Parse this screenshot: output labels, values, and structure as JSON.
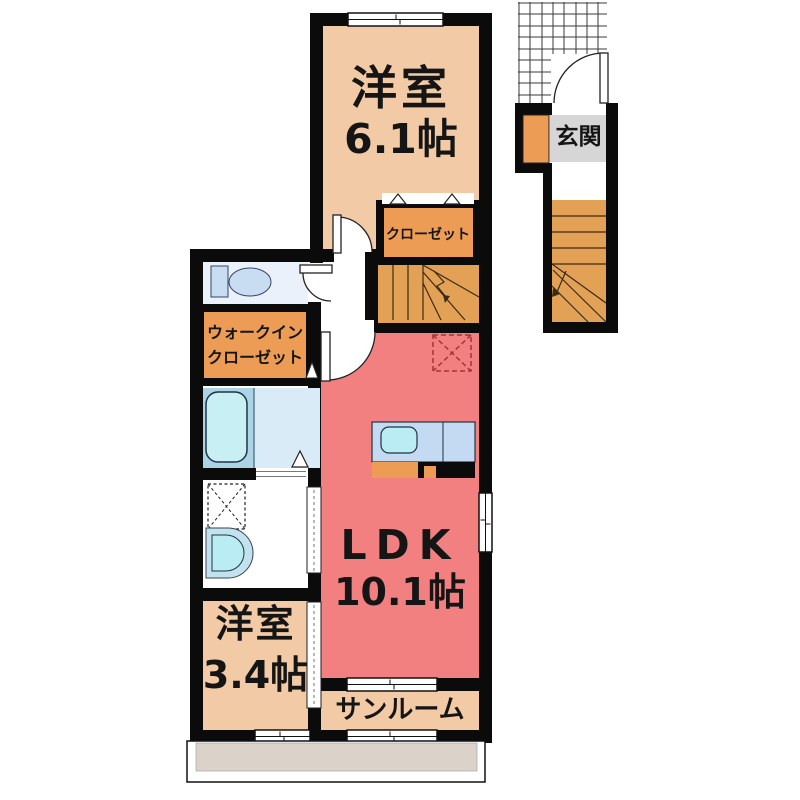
{
  "floorplan": {
    "rooms": {
      "western_room_1": {
        "label": "洋室",
        "size": "6.1帖"
      },
      "closet": {
        "label": "クローゼット"
      },
      "entrance": {
        "label": "玄関"
      },
      "walk_in_closet": {
        "line1": "ウォークイン",
        "line2": "クローゼット"
      },
      "ldk": {
        "label": "LDK",
        "size": "10.1帖"
      },
      "western_room_2": {
        "label": "洋室",
        "size": "3.4帖"
      },
      "sunroom": {
        "label": "サンルーム"
      }
    },
    "colors": {
      "room_peach": "#F2CBA6",
      "closet_orange": "#EC9C54",
      "stairs_orange": "#E3A156",
      "ldk_red": "#F28080",
      "entrance_gray": "#D6D6D6",
      "bath_floor_blue": "#D9EBF6",
      "bath_panel_blue": "#ABD4E6",
      "tub_cyan": "#C8EFF4",
      "toilet_floor": "#EAF1FA",
      "fixture_blue": "#C9DDF2",
      "kitchen_counter_blue": "#C3DAF2",
      "sink_cyan": "#B9EDF3",
      "balcony_tan": "#DBD3CA",
      "wall_black": "#0B0B0B",
      "marker_red": "#A03636"
    }
  }
}
